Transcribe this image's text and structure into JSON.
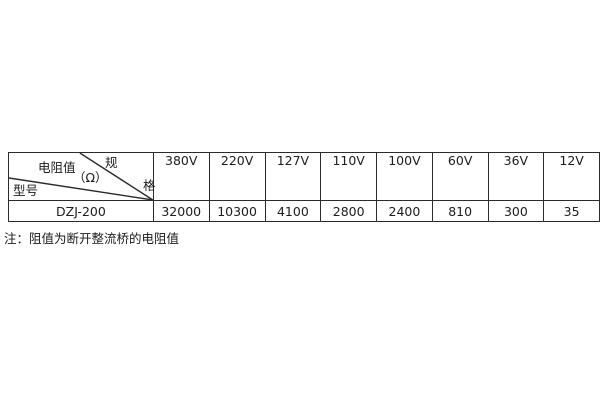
{
  "table": {
    "corner": {
      "spec_char_top": "规",
      "spec_char_bottom": "格",
      "middle_label": "电阻值",
      "middle_unit": "（Ω）",
      "bottom_left_label": "型号"
    },
    "columns": [
      "380V",
      "220V",
      "127V",
      "110V",
      "100V",
      "60V",
      "36V",
      "12V"
    ],
    "rows": [
      {
        "model": "DZJ-200",
        "values": [
          "32000",
          "10300",
          "4100",
          "2800",
          "2400",
          "810",
          "300",
          "35"
        ]
      }
    ]
  },
  "note": "注：阻值为断开整流桥的电阻值",
  "colors": {
    "background": "#ffffff",
    "border": "#2b2b2b",
    "text": "#1c1c1c"
  }
}
